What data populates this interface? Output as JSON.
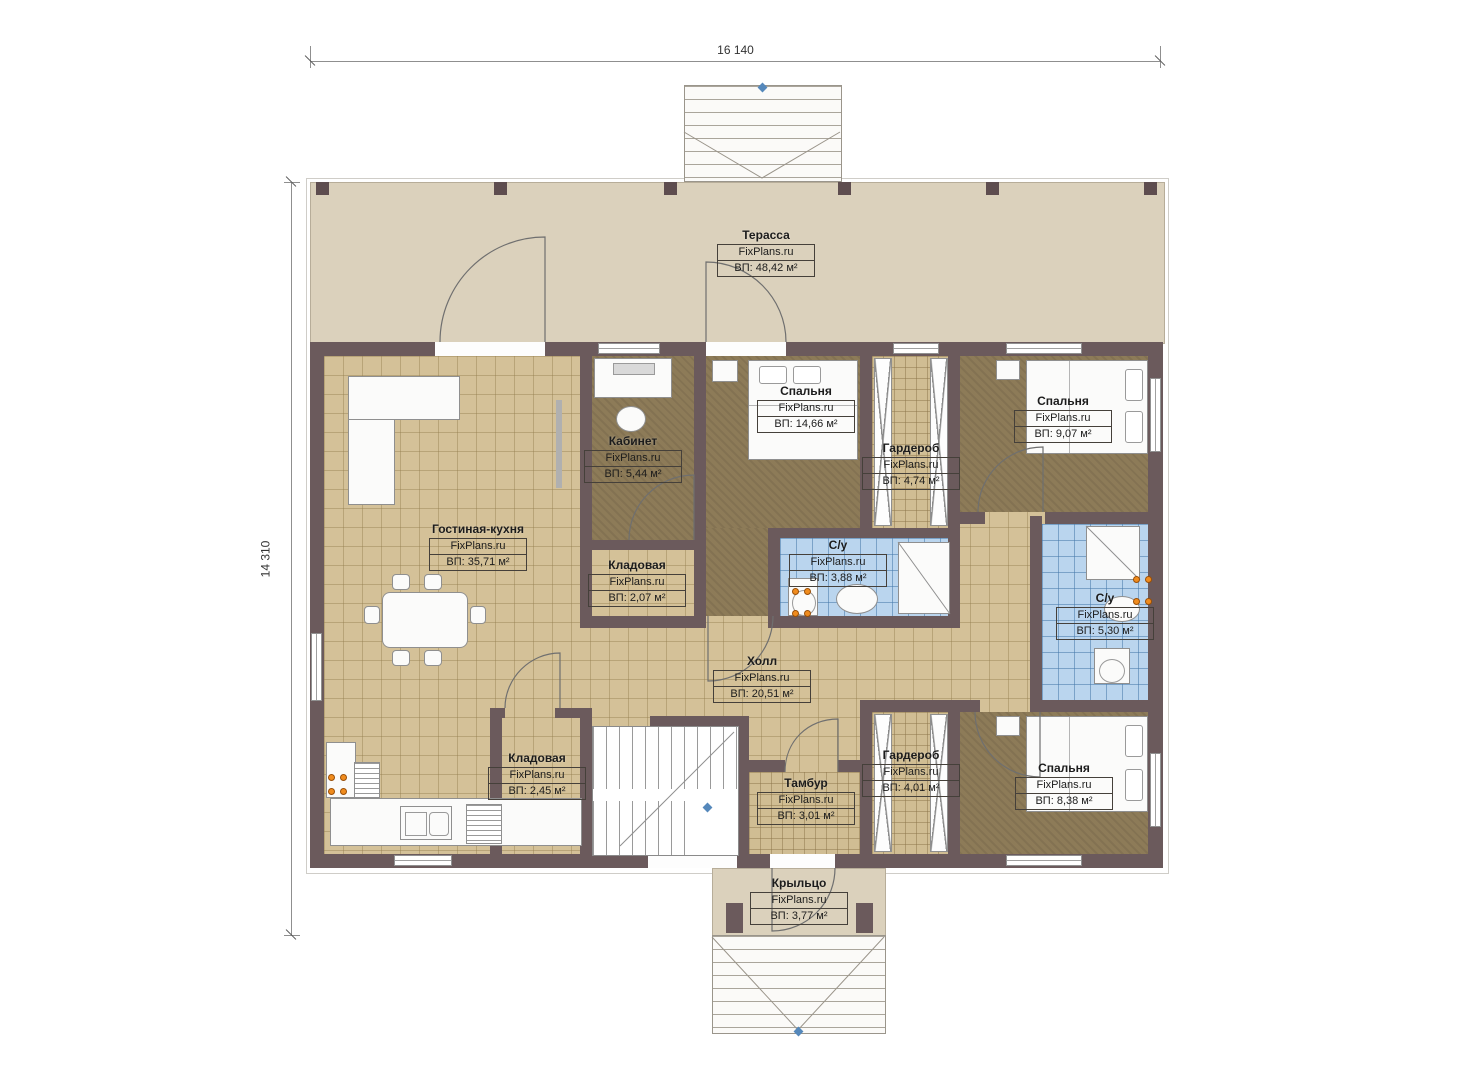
{
  "brand": "FixPlans.ru",
  "dimensions": {
    "top": "16 140",
    "left": "14 310"
  },
  "rooms": [
    {
      "id": "terrace",
      "name": "Терасса",
      "brand": "FixPlans.ru",
      "area": "ВП: 48,42 м²"
    },
    {
      "id": "living",
      "name": "Гостиная-кухня",
      "brand": "FixPlans.ru",
      "area": "ВП: 35,71 м²"
    },
    {
      "id": "office",
      "name": "Кабинет",
      "brand": "FixPlans.ru",
      "area": "ВП: 5,44 м²"
    },
    {
      "id": "bedroom-1",
      "name": "Спальня",
      "brand": "FixPlans.ru",
      "area": "ВП: 14,66 м²"
    },
    {
      "id": "wardrobe-1",
      "name": "Гардероб",
      "brand": "FixPlans.ru",
      "area": "ВП: 4,74 м²"
    },
    {
      "id": "bedroom-2",
      "name": "Спальня",
      "brand": "FixPlans.ru",
      "area": "ВП: 9,07 м²"
    },
    {
      "id": "storage-1",
      "name": "Кладовая",
      "brand": "FixPlans.ru",
      "area": "ВП: 2,07 м²"
    },
    {
      "id": "bath-1",
      "name": "С/у",
      "brand": "FixPlans.ru",
      "area": "ВП: 3,88 м²"
    },
    {
      "id": "bath-2",
      "name": "С/у",
      "brand": "FixPlans.ru",
      "area": "ВП: 5,30 м²"
    },
    {
      "id": "hall",
      "name": "Холл",
      "brand": "FixPlans.ru",
      "area": "ВП: 20,51 м²"
    },
    {
      "id": "storage-2",
      "name": "Кладовая",
      "brand": "FixPlans.ru",
      "area": "ВП: 2,45 м²"
    },
    {
      "id": "vestibule",
      "name": "Тамбур",
      "brand": "FixPlans.ru",
      "area": "ВП: 3,01 м²"
    },
    {
      "id": "wardrobe-2",
      "name": "Гардероб",
      "brand": "FixPlans.ru",
      "area": "ВП: 4,01 м²"
    },
    {
      "id": "bedroom-3",
      "name": "Спальня",
      "brand": "FixPlans.ru",
      "area": "ВП: 8,38 м²"
    },
    {
      "id": "porch",
      "name": "Крыльцо",
      "brand": "FixPlans.ru",
      "area": "ВП: 3,77 м²"
    }
  ],
  "colors": {
    "wall": "#6b5a5c",
    "terrace": "#dbd1bc",
    "tile": "#d4c198",
    "carpet": "#8d7b58",
    "bath_tile": "#bad5ee",
    "accent_orange": "#f08c1e",
    "marker_blue": "#5588bb"
  }
}
